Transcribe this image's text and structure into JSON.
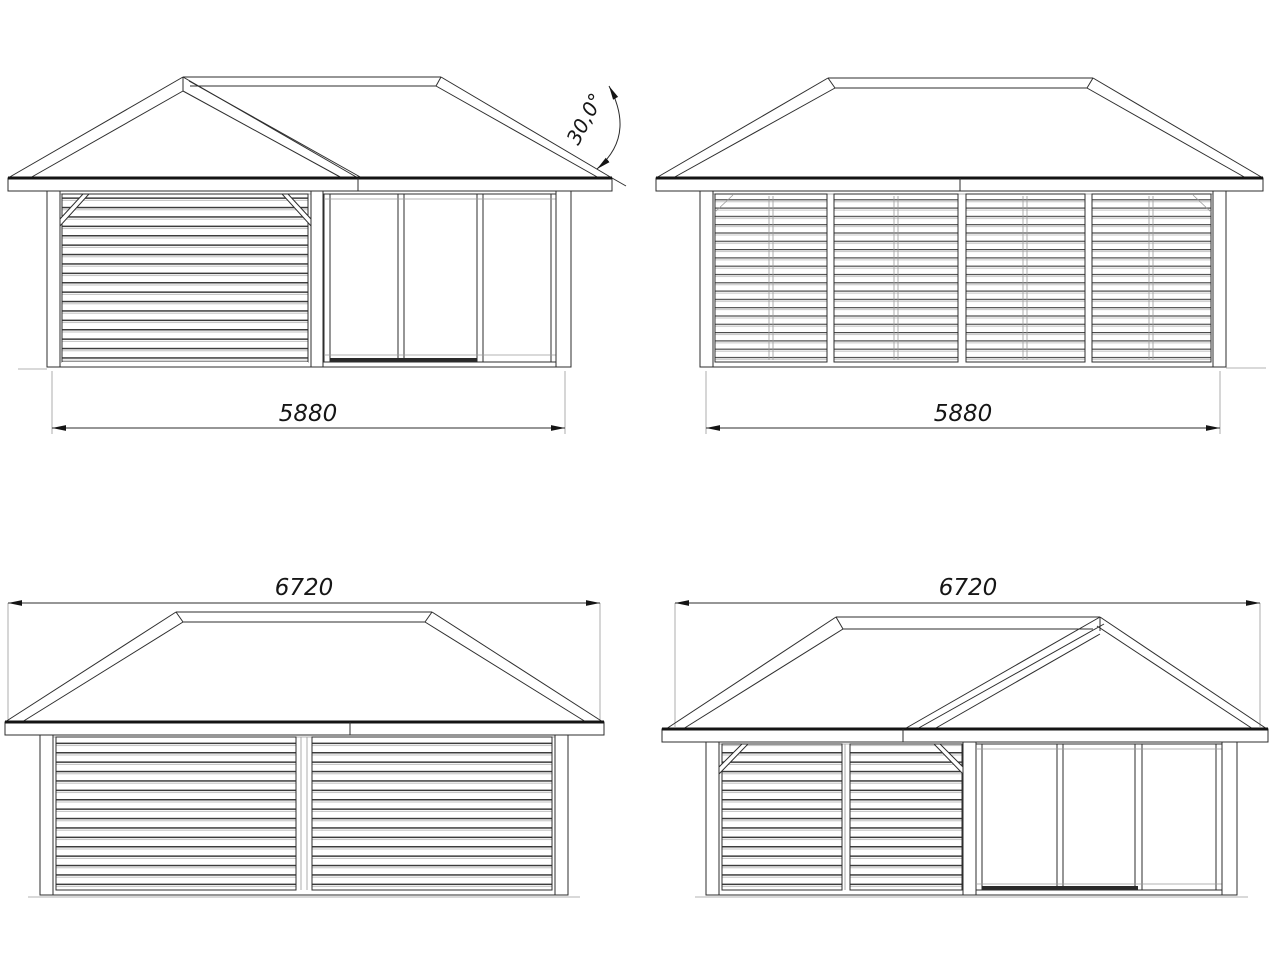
{
  "drawing": {
    "type": "architectural-elevations",
    "background_color": "#ffffff",
    "line_color": "#2e2e2e",
    "thick_line_color": "#141414",
    "light_line_color": "#9a9a9a",
    "views": [
      {
        "id": "front-elevation",
        "position": "top-left",
        "dimension_label": "5880",
        "roof_angle_label": "30,0°"
      },
      {
        "id": "side-elevation-a",
        "position": "top-right",
        "dimension_label": "5880"
      },
      {
        "id": "rear-elevation",
        "position": "bottom-left",
        "dimension_label": "6720"
      },
      {
        "id": "side-elevation-b",
        "position": "bottom-right",
        "dimension_label": "6720"
      }
    ]
  }
}
